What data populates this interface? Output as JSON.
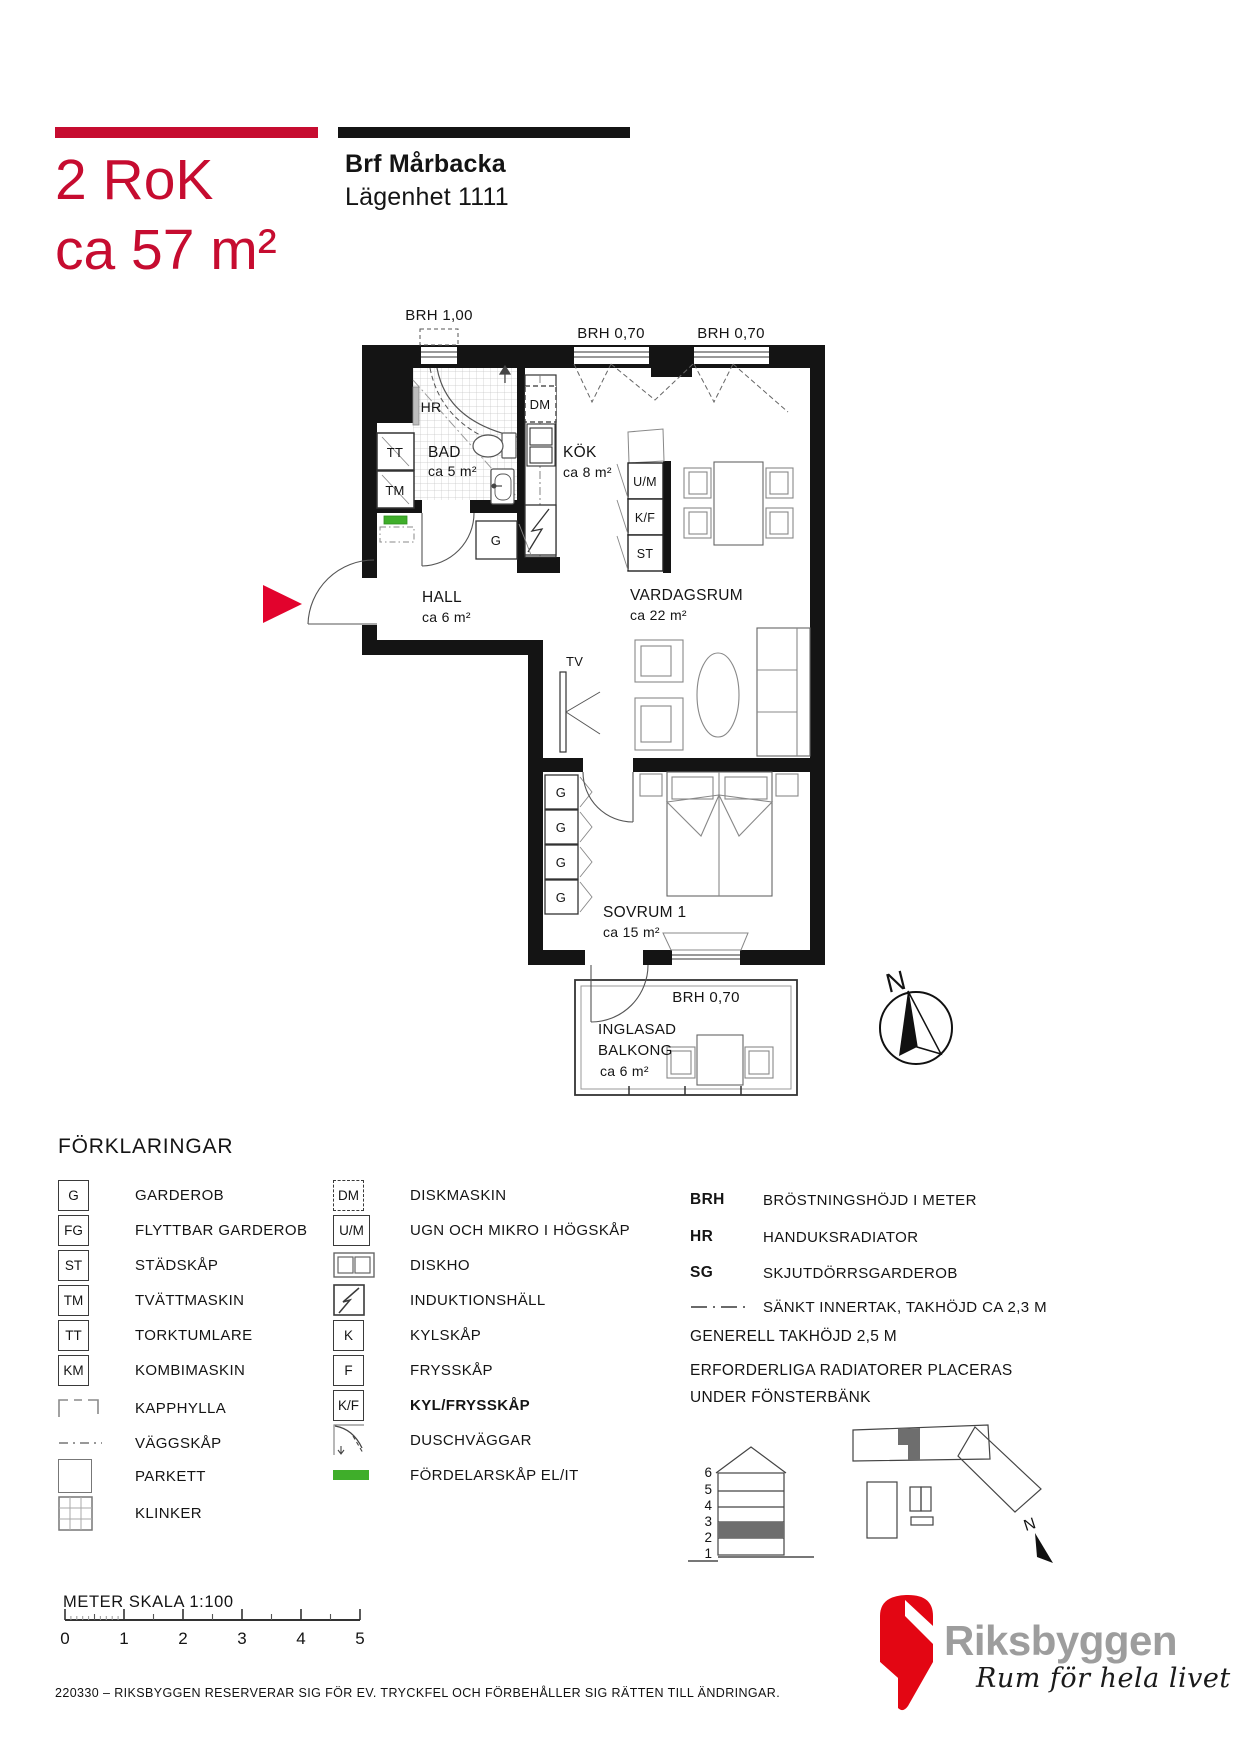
{
  "colors": {
    "red_title": "#c60c30",
    "red_arrow": "#e2032d",
    "red_logo": "#e30613",
    "green_fordelarskap": "#3fae2a",
    "wall_black": "#141414"
  },
  "header": {
    "type_label": "2 RoK",
    "size_label": "ca 57 m²",
    "project_name": "Brf Mårbacka",
    "apartment_label": "Lägenhet 1111"
  },
  "plan": {
    "windows": {
      "top_left": "BRH 1,00",
      "top_mid": "BRH 0,70",
      "top_right": "BRH 0,70",
      "balcony": "BRH 0,70"
    },
    "rooms": {
      "hall": {
        "name": "HALL",
        "area": "ca 6 m²"
      },
      "bad": {
        "name": "BAD",
        "area": "ca 5 m²"
      },
      "kok": {
        "name": "KÖK",
        "area": "ca 8 m²"
      },
      "vardagsrum": {
        "name": "VARDAGSRUM",
        "area": "ca 22 m²"
      },
      "sovrum": {
        "name": "SOVRUM 1",
        "area": "ca 15 m²"
      },
      "balkong": {
        "name_line1": "INGLASAD",
        "name_line2": "BALKONG",
        "area": "ca 6 m²"
      }
    },
    "markers": {
      "hr": "HR",
      "tt": "TT",
      "tm": "TM",
      "dm": "DM",
      "g_hall": "G",
      "um": "U/M",
      "kf": "K/F",
      "st": "ST",
      "tv": "TV",
      "g1": "G",
      "g2": "G",
      "g3": "G",
      "g4": "G"
    },
    "compass": {
      "north": "N"
    }
  },
  "legend": {
    "heading": "FÖRKLARINGAR",
    "col1": [
      {
        "symbol": "G",
        "label": "GARDEROB"
      },
      {
        "symbol": "FG",
        "label": "FLYTTBAR GARDEROB"
      },
      {
        "symbol": "ST",
        "label": "STÄDSKÅP"
      },
      {
        "symbol": "TM",
        "label": "TVÄTTMASKIN"
      },
      {
        "symbol": "TT",
        "label": "TORKTUMLARE"
      },
      {
        "symbol": "KM",
        "label": "KOMBIMASKIN"
      },
      {
        "symbol": "",
        "label": "KAPPHYLLA"
      },
      {
        "symbol": "",
        "label": "VÄGGSKÅP"
      },
      {
        "symbol": "",
        "label": "PARKETT"
      },
      {
        "symbol": "",
        "label": "KLINKER"
      }
    ],
    "col2": [
      {
        "symbol": "DM",
        "label": "DISKMASKIN"
      },
      {
        "symbol": "U/M",
        "label": "UGN OCH MIKRO I HÖGSKÅP"
      },
      {
        "symbol": "",
        "label": "DISKHO"
      },
      {
        "symbol": "",
        "label": "INDUKTIONSHÄLL"
      },
      {
        "symbol": "K",
        "label": "KYLSKÅP"
      },
      {
        "symbol": "F",
        "label": "FRYSSKÅP"
      },
      {
        "symbol": "K/F",
        "label": "KYL/FRYSSKÅP"
      },
      {
        "symbol": "",
        "label": "DUSCHVÄGGAR"
      },
      {
        "symbol": "",
        "label": "FÖRDELARSKÅP EL/IT"
      }
    ],
    "col3": [
      {
        "term": "BRH",
        "label": "BRÖSTNINGSHÖJD I METER"
      },
      {
        "term": "HR",
        "label": "HANDUKSRADIATOR"
      },
      {
        "term": "SG",
        "label": "SKJUTDÖRRSGARDEROB"
      },
      {
        "term": "",
        "label": "SÄNKT INNERTAK, TAKHÖJD CA 2,3 M"
      }
    ],
    "notes": [
      "GENERELL TAKHÖJD 2,5 M",
      "ERFORDERLIGA RADIATORER PLACERAS",
      "UNDER FÖNSTERBÄNK"
    ]
  },
  "site": {
    "floors": [
      "6",
      "5",
      "4",
      "3",
      "2",
      "1"
    ],
    "north": "N"
  },
  "scalebar": {
    "label": "METER  SKALA 1:100",
    "ticks": [
      "0",
      "1",
      "2",
      "3",
      "4",
      "5"
    ]
  },
  "footer": {
    "disclaimer": "220330 – RIKSBYGGEN RESERVERAR SIG FÖR EV. TRYCKFEL OCH FÖRBEHÅLLER SIG RÄTTEN TILL ÄNDRINGAR."
  },
  "logo": {
    "brand": "Riksbyggen",
    "tagline": "Rum för hela livet"
  }
}
